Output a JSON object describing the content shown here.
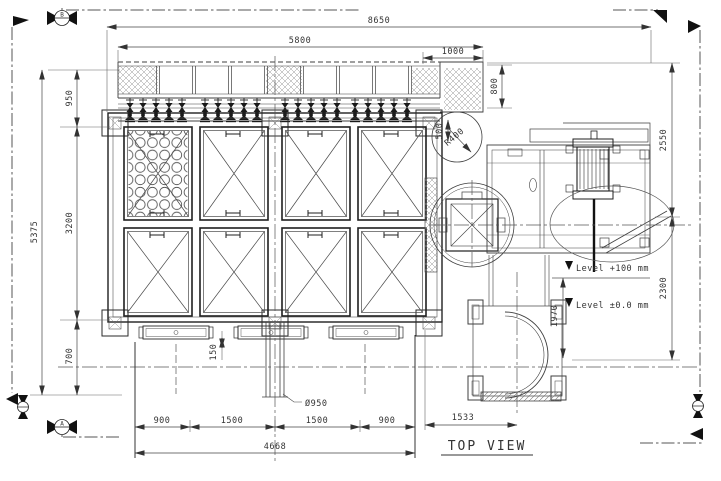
{
  "drawing": {
    "view_label": "TOP VIEW",
    "dims": {
      "overall_width": "8650",
      "duct_width": "5800",
      "duct_ext": "1000",
      "overall_height": "5375",
      "left_top": "950",
      "left_mid": "3200",
      "left_bottom": "700",
      "duct_depth": "800",
      "opening": "500",
      "fan_radius": "R400",
      "right_upper": "2550",
      "right_lower": "2300",
      "level_drop": "1970",
      "base_segments": [
        "900",
        "1500",
        "1500",
        "900"
      ],
      "base_overall": "4668",
      "fan_offset": "1533",
      "beam_gap": "150",
      "duct_dia": "Ø950"
    },
    "levels": {
      "high": "Level +100 mm",
      "zero": "Level ±0.0 mm"
    },
    "sections": {
      "b": "B",
      "a": "A"
    }
  },
  "colors": {
    "line": "#3f3f3f",
    "dark": "#1a1a1a",
    "hatch": "#949494",
    "dim": "#444444"
  }
}
